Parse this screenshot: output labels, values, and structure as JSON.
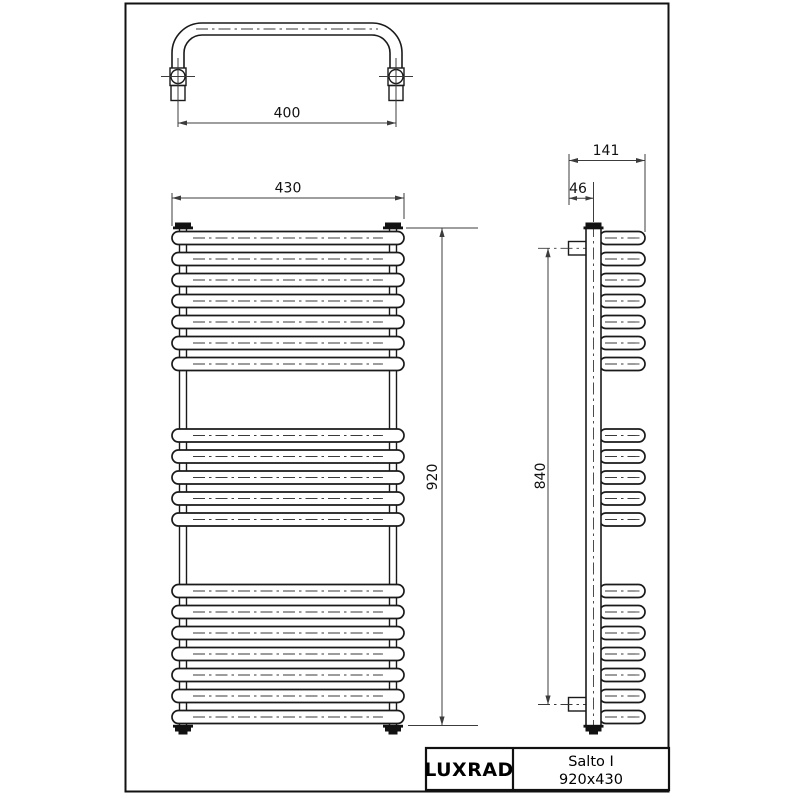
{
  "drawing": {
    "title_block": {
      "brand": "LUXRAD",
      "model": "Salto I",
      "size_label": "920x430"
    },
    "dimensions": {
      "axle_spacing": "400",
      "width": "430",
      "height": "920",
      "depth": "141",
      "wall_offset": "46",
      "mounting_height": "840"
    },
    "front_rung_groups": [
      7,
      5,
      7
    ],
    "colors": {
      "line": "#1a1a1a",
      "dim": "#3c3c3c",
      "background": "#ffffff"
    }
  }
}
